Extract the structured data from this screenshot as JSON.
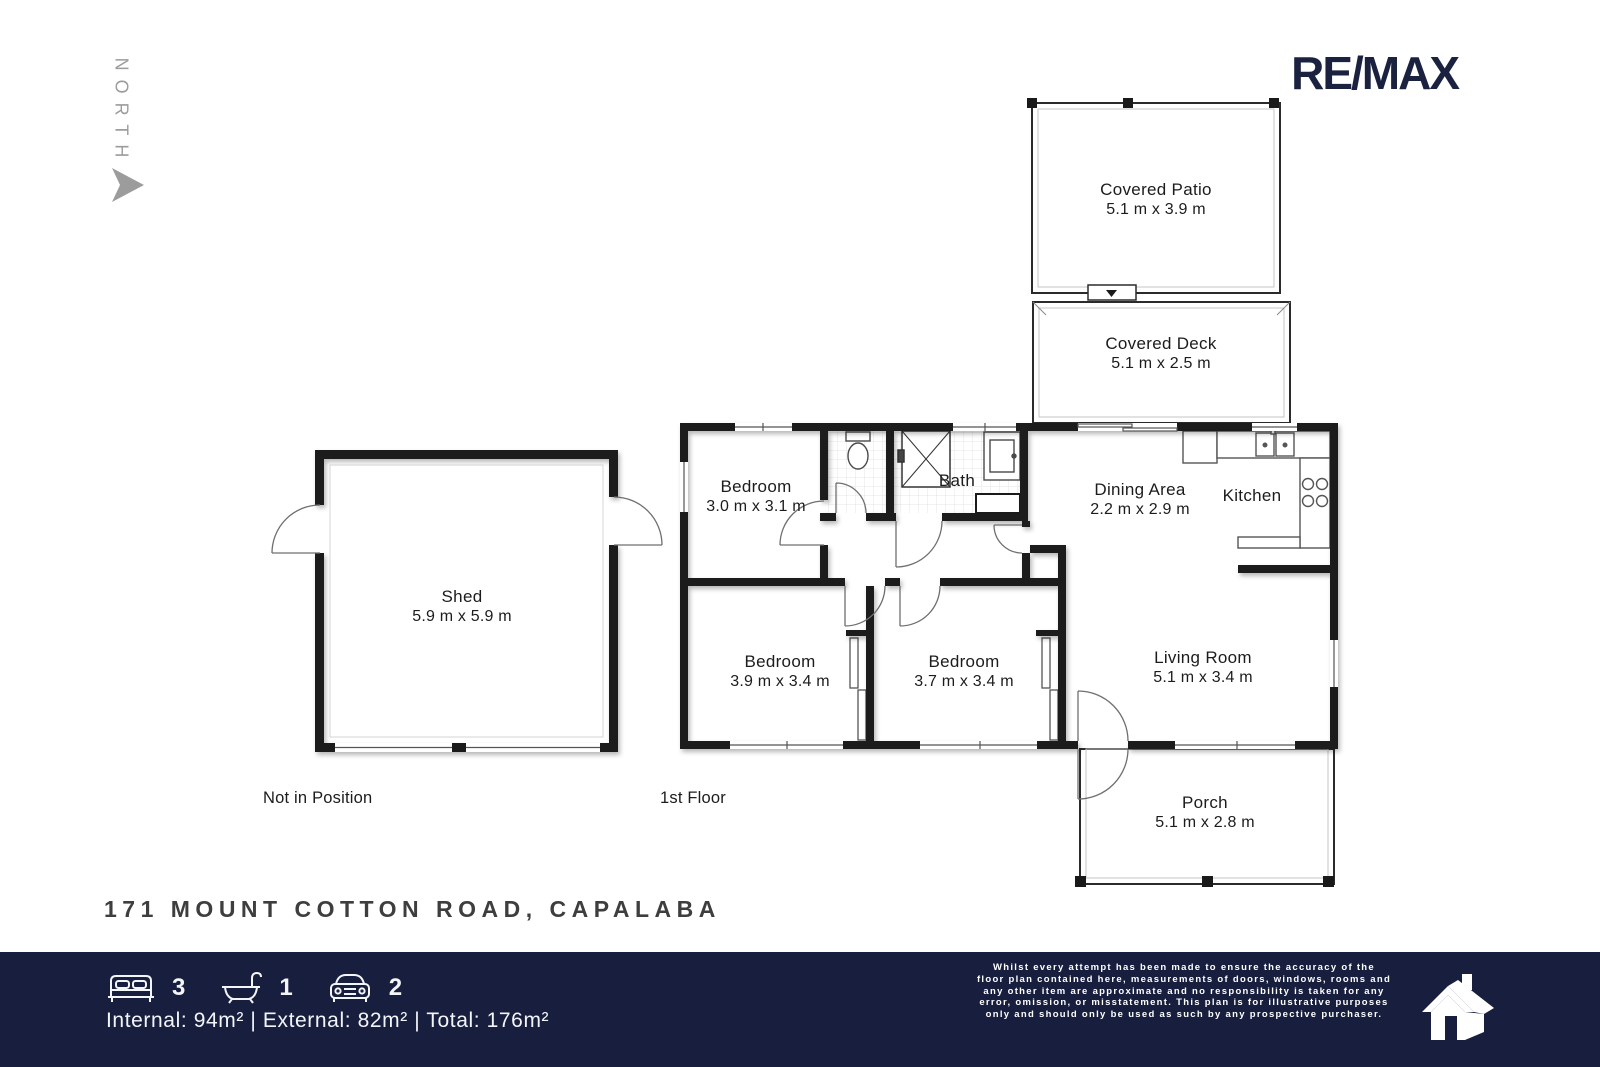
{
  "north": {
    "label": "NORTH"
  },
  "brand": {
    "logo_text": "RE/MAX"
  },
  "plan": {
    "rooms": [
      {
        "name": "Covered Patio",
        "dims": "5.1 m x 3.9 m"
      },
      {
        "name": "Covered Deck",
        "dims": "5.1 m x 2.5 m"
      },
      {
        "name": "Bedroom",
        "dims": "3.0 m x 3.1 m"
      },
      {
        "name": "Bath",
        "dims": ""
      },
      {
        "name": "Dining Area",
        "dims": "2.2 m x 2.9 m"
      },
      {
        "name": "Kitchen",
        "dims": ""
      },
      {
        "name": "Bedroom",
        "dims": "3.9 m x 3.4 m"
      },
      {
        "name": "Bedroom",
        "dims": "3.7 m x 3.4 m"
      },
      {
        "name": "Living Room",
        "dims": "5.1 m x 3.4 m"
      },
      {
        "name": "Porch",
        "dims": "5.1 m x 2.8 m"
      },
      {
        "name": "Shed",
        "dims": "5.9 m x 5.9 m"
      }
    ],
    "captions": {
      "not_in_position": "Not in Position",
      "floor": "1st Floor"
    }
  },
  "address": "171 MOUNT COTTON ROAD, CAPALABA",
  "footer": {
    "beds": "3",
    "baths": "1",
    "cars": "2",
    "areas": "Internal: 94m² | External: 82m² | Total: 176m²",
    "disclaimer": "Whilst every attempt has been made to ensure the accuracy of the\nfloor plan contained here, measurements of doors, windows, rooms and\nany other item are approximate and no responsibility is taken for any\nerror, omission, or misstatement. This plan is for illustrative purposes\nonly and should only be used as such by any prospective purchaser."
  },
  "colors": {
    "navy": "#171e3e",
    "logo_navy": "#1a2240",
    "wall_black": "#1a1a1a",
    "compass_gray": "#9c9c9c",
    "address_gray": "#3e3e3e"
  }
}
